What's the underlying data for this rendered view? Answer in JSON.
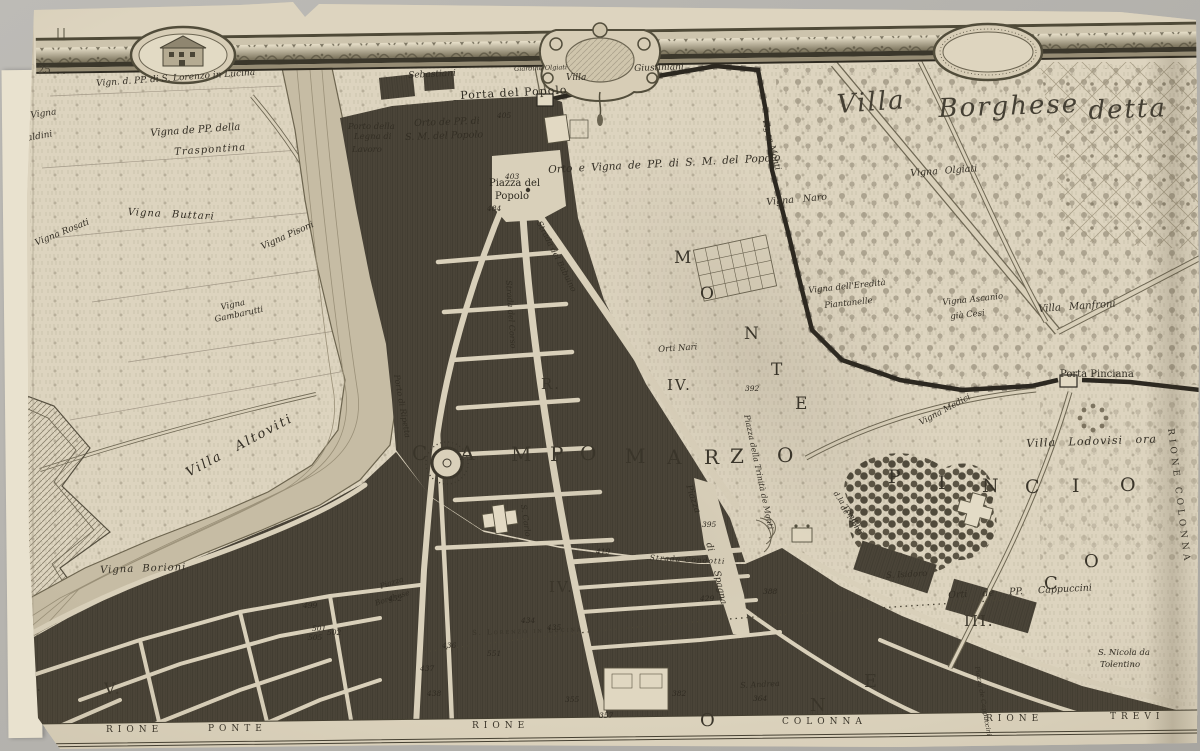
{
  "palette": {
    "paper": "#ddd4bf",
    "ink": "#3a352a",
    "city_block": "#4a4438",
    "river": "#c6bca4",
    "frieze_dark": "#3b372b"
  },
  "sheet": {
    "corner_number": "25"
  },
  "cartouches": {
    "left": "house-vignette-icon",
    "center": "scroll-ornament-icon",
    "right": "crescent-moon-icon"
  },
  "labels": [
    {
      "t": "Vign. d. PP. di S. Lorenzo in Lucina",
      "x": 96,
      "y": 80,
      "r": -4,
      "s": 9,
      "c": "it"
    },
    {
      "t": "Vigna",
      "x": 30,
      "y": 112,
      "r": -8,
      "s": 9,
      "c": "it"
    },
    {
      "t": "Baldini",
      "x": 20,
      "y": 136,
      "r": -10,
      "s": 9,
      "c": "it"
    },
    {
      "t": "Vigna de PP. della",
      "x": 150,
      "y": 129,
      "r": -4,
      "s": 10,
      "c": "it"
    },
    {
      "t": "Traspontina",
      "x": 174,
      "y": 148,
      "r": -4,
      "s": 10,
      "c": "it",
      "ls": 1
    },
    {
      "t": "Sebastiani",
      "x": 408,
      "y": 72,
      "r": -3,
      "s": 9,
      "c": "it"
    },
    {
      "t": "Giardino Olgiati",
      "x": 514,
      "y": 66,
      "r": -2,
      "s": 6.5,
      "c": "it"
    },
    {
      "t": "Villa",
      "x": 566,
      "y": 74,
      "s": 9,
      "c": "it"
    },
    {
      "t": "Giustiniani",
      "x": 634,
      "y": 65,
      "r": -2,
      "s": 9,
      "c": "it"
    },
    {
      "t": "Porta del Popolo",
      "x": 460,
      "y": 90,
      "r": -3,
      "s": 11,
      "c": "rm",
      "ls": 1
    },
    {
      "t": "Orto de PP. di",
      "x": 414,
      "y": 119,
      "r": -2,
      "s": 9.5,
      "c": "it"
    },
    {
      "t": "S. M. del Popolo",
      "x": 405,
      "y": 133,
      "r": -2,
      "s": 9.5,
      "c": "it"
    },
    {
      "t": "Porto della",
      "x": 348,
      "y": 123,
      "s": 8.5,
      "c": "it"
    },
    {
      "t": "Legna di",
      "x": 354,
      "y": 133,
      "s": 8.5,
      "c": "it"
    },
    {
      "t": "Lavoro",
      "x": 352,
      "y": 146,
      "s": 8.5,
      "c": "it"
    },
    {
      "t": "Piazza del",
      "x": 489,
      "y": 179,
      "s": 10,
      "c": "rm"
    },
    {
      "t": "Popolo",
      "x": 495,
      "y": 192,
      "s": 10,
      "c": "rm"
    },
    {
      "t": "Villa",
      "x": 836,
      "y": 92,
      "r": -4,
      "s": 26,
      "c": "scr"
    },
    {
      "t": "Borghese",
      "x": 938,
      "y": 96,
      "r": -2,
      "s": 26,
      "c": "scr"
    },
    {
      "t": "detta",
      "x": 1088,
      "y": 98,
      "r": -2,
      "s": 26,
      "c": "scr"
    },
    {
      "t": "Orto e Vigna de PP. di S. M. del Popolo",
      "x": 548,
      "y": 165,
      "r": -3,
      "s": 10.5,
      "c": "it",
      "ws": 3
    },
    {
      "t": "Vigna Monti",
      "x": 768,
      "y": 118,
      "r": 75,
      "s": 8.5,
      "c": "it"
    },
    {
      "t": "Vigna Naro",
      "x": 766,
      "y": 198,
      "r": -5,
      "s": 9.5,
      "c": "it",
      "ws": 6
    },
    {
      "t": "Vigna Olgiati",
      "x": 910,
      "y": 169,
      "r": -4,
      "s": 9.5,
      "c": "it",
      "ws": 4
    },
    {
      "t": "Vigna dell'Eredità",
      "x": 808,
      "y": 287,
      "r": -6,
      "s": 8.5,
      "c": "it"
    },
    {
      "t": "Piantanelle",
      "x": 824,
      "y": 302,
      "r": -6,
      "s": 8.5,
      "c": "it"
    },
    {
      "t": "Vigna Ascanio",
      "x": 942,
      "y": 299,
      "r": -6,
      "s": 8.5,
      "c": "it"
    },
    {
      "t": "già Cesi",
      "x": 950,
      "y": 313,
      "r": -6,
      "s": 8.5,
      "c": "it"
    },
    {
      "t": "Villa Manfroni",
      "x": 1038,
      "y": 305,
      "r": -4,
      "s": 10,
      "c": "it",
      "ws": 5
    },
    {
      "t": "Vigna Medici",
      "x": 918,
      "y": 420,
      "r": -28,
      "s": 8.5,
      "c": "it"
    },
    {
      "t": "Porta Pinciana",
      "x": 1060,
      "y": 370,
      "s": 10,
      "c": "rm"
    },
    {
      "t": "Villa Lodovisi ora",
      "x": 1026,
      "y": 438,
      "r": -2,
      "s": 11,
      "c": "it",
      "ws": 8,
      "ls": 1
    },
    {
      "t": "M",
      "x": 674,
      "y": 250,
      "s": 17,
      "c": "big"
    },
    {
      "t": "O",
      "x": 700,
      "y": 286,
      "s": 17,
      "c": "big"
    },
    {
      "t": "N",
      "x": 744,
      "y": 326,
      "s": 17,
      "c": "big"
    },
    {
      "t": "T",
      "x": 771,
      "y": 362,
      "s": 17,
      "c": "big"
    },
    {
      "t": "E",
      "x": 795,
      "y": 396,
      "s": 17,
      "c": "big"
    },
    {
      "t": "P",
      "x": 888,
      "y": 468,
      "s": 19,
      "c": "big"
    },
    {
      "t": "I",
      "x": 938,
      "y": 474,
      "s": 19,
      "c": "big"
    },
    {
      "t": "N",
      "x": 982,
      "y": 477,
      "s": 19,
      "c": "big"
    },
    {
      "t": "C",
      "x": 1025,
      "y": 478,
      "s": 19,
      "c": "big"
    },
    {
      "t": "I",
      "x": 1072,
      "y": 477,
      "s": 19,
      "c": "big"
    },
    {
      "t": "O",
      "x": 1120,
      "y": 476,
      "s": 19,
      "c": "big"
    },
    {
      "t": "C",
      "x": 412,
      "y": 443,
      "s": 20,
      "c": "big"
    },
    {
      "t": "A",
      "x": 460,
      "y": 443,
      "s": 20,
      "c": "big"
    },
    {
      "t": "M",
      "x": 511,
      "y": 444,
      "s": 20,
      "c": "big"
    },
    {
      "t": "P",
      "x": 550,
      "y": 444,
      "s": 20,
      "c": "big"
    },
    {
      "t": "O",
      "x": 580,
      "y": 443,
      "s": 20,
      "c": "big"
    },
    {
      "t": "M",
      "x": 625,
      "y": 446,
      "s": 20,
      "c": "big"
    },
    {
      "t": "A",
      "x": 667,
      "y": 447,
      "s": 20,
      "c": "big"
    },
    {
      "t": "R",
      "x": 704,
      "y": 447,
      "s": 20,
      "c": "big"
    },
    {
      "t": "Z",
      "x": 730,
      "y": 446,
      "s": 20,
      "c": "big"
    },
    {
      "t": "O",
      "x": 777,
      "y": 445,
      "s": 20,
      "c": "big"
    },
    {
      "t": "R.",
      "x": 541,
      "y": 377,
      "s": 15,
      "c": "big"
    },
    {
      "t": "IV.",
      "x": 667,
      "y": 378,
      "s": 15,
      "c": "big"
    },
    {
      "t": "IV.",
      "x": 549,
      "y": 580,
      "s": 15,
      "c": "big"
    },
    {
      "t": "R.",
      "x": 22,
      "y": 678,
      "s": 16,
      "c": "big"
    },
    {
      "t": "V.",
      "x": 104,
      "y": 681,
      "s": 16,
      "c": "big"
    },
    {
      "t": "O",
      "x": 700,
      "y": 712,
      "s": 18,
      "c": "big"
    },
    {
      "t": "N",
      "x": 810,
      "y": 697,
      "s": 18,
      "c": "big"
    },
    {
      "t": "E",
      "x": 864,
      "y": 673,
      "s": 18,
      "c": "big"
    },
    {
      "t": "III.",
      "x": 964,
      "y": 614,
      "s": 15,
      "c": "big"
    },
    {
      "t": "C",
      "x": 1044,
      "y": 575,
      "s": 18,
      "c": "big"
    },
    {
      "t": "O",
      "x": 1084,
      "y": 553,
      "s": 18,
      "c": "big"
    },
    {
      "t": "Strada del Corso",
      "x": 512,
      "y": 280,
      "r": 86,
      "s": 8,
      "c": "it"
    },
    {
      "t": "Strada del Babuino",
      "x": 542,
      "y": 220,
      "r": 63,
      "s": 8,
      "c": "it"
    },
    {
      "t": "Porto di Ripetta",
      "x": 400,
      "y": 374,
      "r": 80,
      "s": 8,
      "c": "it"
    },
    {
      "t": "S. Carlo",
      "x": 527,
      "y": 504,
      "r": 82,
      "s": 8,
      "c": "it"
    },
    {
      "t": "Strada Condotti",
      "x": 650,
      "y": 554,
      "r": 3,
      "s": 7.5,
      "c": "it",
      "ls": 1
    },
    {
      "t": "S. Lorenzo in Lucina",
      "x": 472,
      "y": 630,
      "r": -2,
      "s": 7,
      "c": "sc2"
    },
    {
      "t": "Piazza",
      "x": 692,
      "y": 484,
      "r": 72,
      "s": 9,
      "c": "it"
    },
    {
      "t": "di",
      "x": 712,
      "y": 542,
      "r": 75,
      "s": 9,
      "c": "it"
    },
    {
      "t": "Spagna",
      "x": 720,
      "y": 570,
      "r": 78,
      "s": 9,
      "c": "it"
    },
    {
      "t": "Piazza della Trinità de Monti",
      "x": 750,
      "y": 414,
      "r": 78,
      "s": 8,
      "c": "it"
    },
    {
      "t": "d.la Trinità",
      "x": 838,
      "y": 490,
      "r": 55,
      "s": 7.5,
      "c": "it"
    },
    {
      "t": "de Monti",
      "x": 845,
      "y": 504,
      "r": 55,
      "s": 7.5,
      "c": "it"
    },
    {
      "t": "Piazza de Cappuccini",
      "x": 980,
      "y": 666,
      "r": 80,
      "s": 6.5,
      "c": "it"
    },
    {
      "t": "RIONE COLONNA",
      "x": 1174,
      "y": 428,
      "r": 83,
      "s": 9,
      "c": "sc",
      "ls": 4
    },
    {
      "t": "S. Isidoro",
      "x": 886,
      "y": 572,
      "r": -3,
      "s": 8.5,
      "c": "it"
    },
    {
      "t": "Orti de PP. Cappuccini",
      "x": 948,
      "y": 591,
      "r": -3,
      "s": 9.5,
      "c": "it",
      "ws": 12
    },
    {
      "t": "S. Nicola da",
      "x": 1098,
      "y": 649,
      "s": 8.5,
      "c": "it"
    },
    {
      "t": "Tolentino",
      "x": 1100,
      "y": 661,
      "s": 8.5,
      "c": "it"
    },
    {
      "t": "S. Andrea",
      "x": 740,
      "y": 682,
      "r": -3,
      "s": 8,
      "c": "it"
    },
    {
      "t": "Piazza",
      "x": 379,
      "y": 583,
      "r": -18,
      "s": 7.5,
      "c": "it"
    },
    {
      "t": "Borghese",
      "x": 374,
      "y": 600,
      "r": -18,
      "s": 7.5,
      "c": "it"
    },
    {
      "t": "Orti Nari",
      "x": 658,
      "y": 346,
      "r": -4,
      "s": 8.5,
      "c": "it"
    },
    {
      "t": "Vigna Borioni",
      "x": 100,
      "y": 566,
      "r": -2,
      "s": 10,
      "c": "it",
      "ws": 4,
      "ls": 1
    },
    {
      "t": "Villa Altoviti",
      "x": 184,
      "y": 468,
      "r": -28,
      "s": 13,
      "c": "it",
      "ws": 10,
      "ls": 2
    },
    {
      "t": "Vigna",
      "x": 220,
      "y": 304,
      "r": -12,
      "s": 8.5,
      "c": "it"
    },
    {
      "t": "Gambarutti",
      "x": 214,
      "y": 316,
      "r": -12,
      "s": 8.5,
      "c": "it"
    },
    {
      "t": "Vigna Buttari",
      "x": 128,
      "y": 208,
      "r": 3,
      "s": 10,
      "c": "it",
      "ws": 6,
      "ls": 1
    },
    {
      "t": "Vigna Pisoni",
      "x": 260,
      "y": 244,
      "r": -24,
      "s": 9,
      "c": "it"
    },
    {
      "t": "Vigna Rosati",
      "x": 34,
      "y": 240,
      "r": -22,
      "s": 9,
      "c": "it"
    },
    {
      "t": "RIONE",
      "x": 106,
      "y": 726,
      "s": 9,
      "c": "sc",
      "ls": 5
    },
    {
      "t": "PONTE",
      "x": 208,
      "y": 725,
      "s": 9,
      "c": "sc",
      "ls": 5
    },
    {
      "t": "RIONE",
      "x": 472,
      "y": 722,
      "s": 9,
      "c": "sc",
      "ls": 5
    },
    {
      "t": "COLONNA",
      "x": 782,
      "y": 718,
      "s": 9,
      "c": "sc",
      "ls": 5
    },
    {
      "t": "RIONE",
      "x": 986,
      "y": 715,
      "s": 9,
      "c": "sc",
      "ls": 5
    },
    {
      "t": "TREVI",
      "x": 1110,
      "y": 713,
      "s": 9,
      "c": "sc",
      "ls": 5
    },
    {
      "t": "405",
      "x": 497,
      "y": 112,
      "s": 7.5,
      "c": "num"
    },
    {
      "t": "403",
      "x": 505,
      "y": 173,
      "s": 7.5,
      "c": "num"
    },
    {
      "t": "484",
      "x": 487,
      "y": 205,
      "s": 7.5,
      "c": "num"
    },
    {
      "t": "392",
      "x": 745,
      "y": 385,
      "s": 7.5,
      "c": "num"
    },
    {
      "t": "395",
      "x": 702,
      "y": 521,
      "s": 7.5,
      "c": "num"
    },
    {
      "t": "419",
      "x": 596,
      "y": 548,
      "s": 7.5,
      "c": "num"
    },
    {
      "t": "429",
      "x": 700,
      "y": 595,
      "s": 7.5,
      "c": "num"
    },
    {
      "t": "388",
      "x": 763,
      "y": 588,
      "s": 7.5,
      "c": "num"
    },
    {
      "t": "382",
      "x": 672,
      "y": 690,
      "s": 7.5,
      "c": "num"
    },
    {
      "t": "355",
      "x": 565,
      "y": 696,
      "s": 7.5,
      "c": "num"
    },
    {
      "t": "357",
      "x": 599,
      "y": 712,
      "s": 7.5,
      "c": "num"
    },
    {
      "t": "551",
      "x": 487,
      "y": 650,
      "s": 7.5,
      "c": "num"
    },
    {
      "t": "434",
      "x": 521,
      "y": 617,
      "s": 7.5,
      "c": "num"
    },
    {
      "t": "435",
      "x": 547,
      "y": 624,
      "s": 7.5,
      "c": "num"
    },
    {
      "t": "436",
      "x": 442,
      "y": 642,
      "s": 7.5,
      "c": "num"
    },
    {
      "t": "437",
      "x": 420,
      "y": 665,
      "s": 7.5,
      "c": "num"
    },
    {
      "t": "438",
      "x": 427,
      "y": 690,
      "s": 7.5,
      "c": "num"
    },
    {
      "t": "499",
      "x": 303,
      "y": 602,
      "s": 7.5,
      "c": "num"
    },
    {
      "t": "501",
      "x": 312,
      "y": 625,
      "s": 7.5,
      "c": "num"
    },
    {
      "t": "502",
      "x": 327,
      "y": 629,
      "s": 7.5,
      "c": "num"
    },
    {
      "t": "505",
      "x": 308,
      "y": 634,
      "s": 7.5,
      "c": "num"
    },
    {
      "t": "452",
      "x": 388,
      "y": 595,
      "s": 7.5,
      "c": "num"
    },
    {
      "t": "364",
      "x": 753,
      "y": 695,
      "s": 7.5,
      "c": "num"
    }
  ]
}
